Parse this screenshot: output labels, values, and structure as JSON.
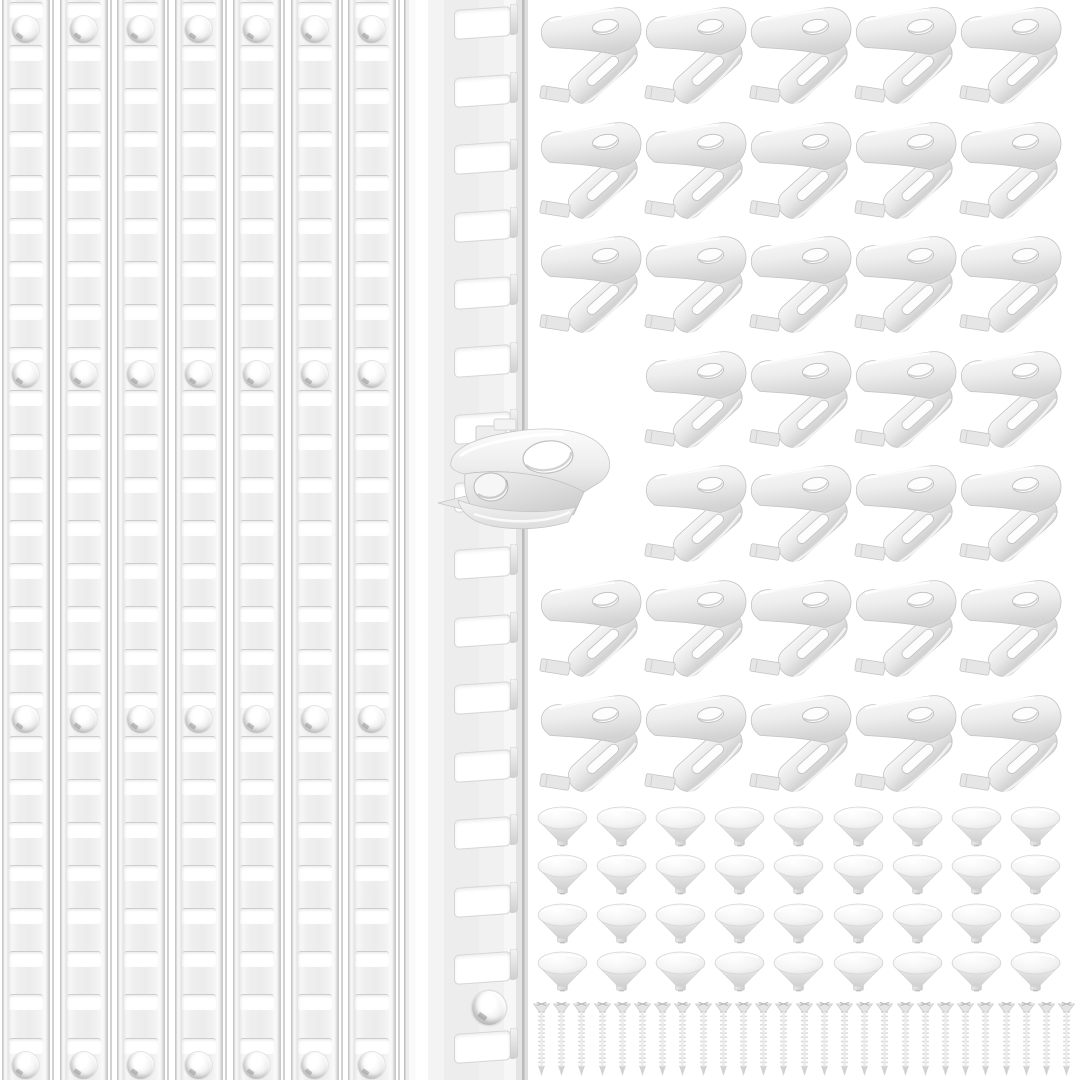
{
  "scene": {
    "kind": "product-photo",
    "subject": "shelf pilaster standards with shelf support clips, pin supports and mounting screws",
    "background_color": "#ffffff"
  },
  "palette": {
    "metal_highlight": "#fbfbfb",
    "metal_body": "#ededed",
    "metal_shadow": "#c6c6c6",
    "slot_fill": "#ffffff",
    "edge_line": "#c2c2c2",
    "hole_crescent": "#8f8f8f"
  },
  "items": {
    "pilaster_standards": {
      "name": "slotted pilaster standard strips",
      "count": 7,
      "slots_per_strip": 25,
      "screw_holes_per_strip": 4
    },
    "featured_standard": {
      "name": "close-up pilaster standard",
      "count": 1,
      "slots": 16,
      "screw_holes": 1,
      "has_attached_clip": true
    },
    "attached_clip": {
      "name": "shelf support clip snapped into standard",
      "count": 1,
      "holes": 2
    },
    "shelf_clips": {
      "name": "spring shelf support clips",
      "rows": 7,
      "columns": 5,
      "hidden_cells": [
        [
          4,
          1
        ],
        [
          5,
          1
        ]
      ],
      "visible_count": 33
    },
    "pin_supports": {
      "name": "round push-in shelf pin caps",
      "rows": 4,
      "columns": 9,
      "count": 36
    },
    "screws": {
      "name": "flat-head mounting screws",
      "count": 27
    }
  }
}
